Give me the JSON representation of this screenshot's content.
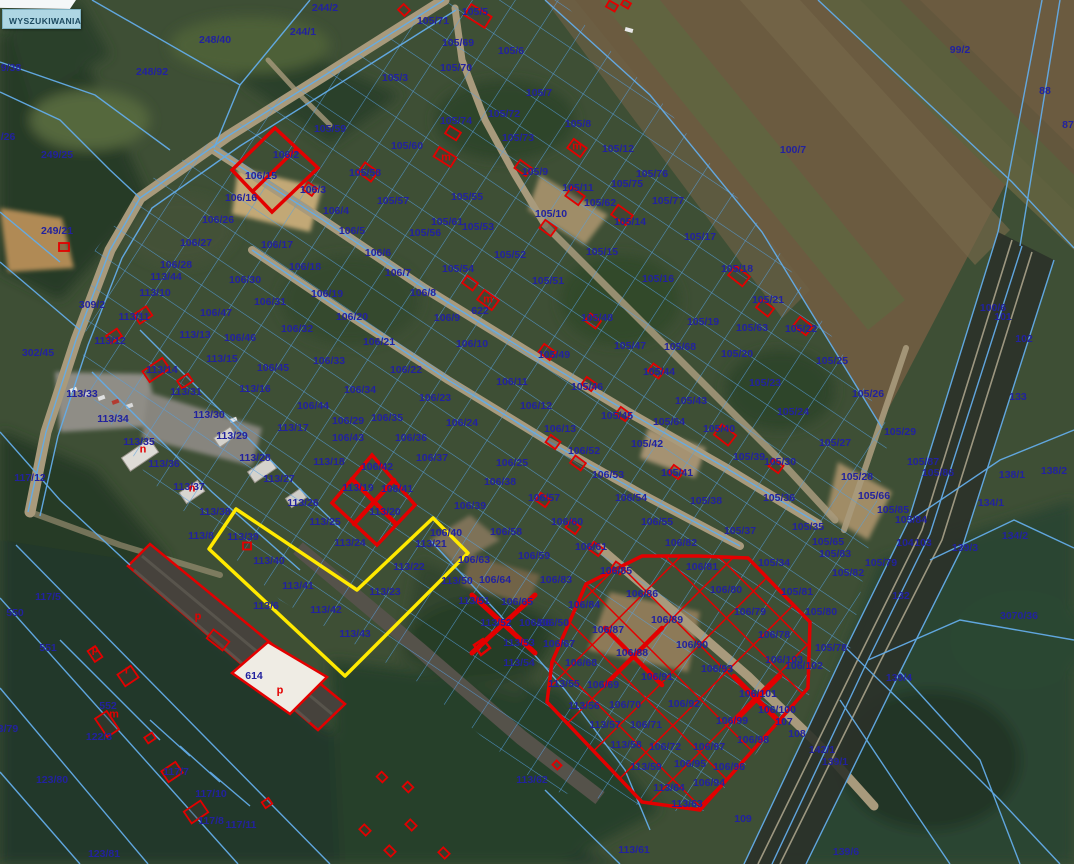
{
  "ui": {
    "search_button": "WYSZUKIWANIA"
  },
  "map": {
    "colors": {
      "parcel_line": "#57a0e0",
      "parcel_label": "#22229e",
      "building_outline": "#e30000",
      "selection_outline": "#ffe900",
      "highlight_grid": "#e30000",
      "field": "#6b5b40",
      "forest": "#273b28",
      "road": "#a89a7c"
    },
    "parcel_labels": [
      [
        "9/38",
        11,
        68
      ],
      [
        "248/92",
        152,
        72
      ],
      [
        "248/40",
        215,
        40
      ],
      [
        "244/2",
        325,
        8
      ],
      [
        "244/1",
        303,
        32
      ],
      [
        "/26",
        8,
        137
      ],
      [
        "249/25",
        57,
        155
      ],
      [
        "249/21",
        57,
        231
      ],
      [
        "309/2",
        92,
        305
      ],
      [
        "302/45",
        38,
        353
      ],
      [
        "105/71",
        433,
        21
      ],
      [
        "105/5",
        475,
        12
      ],
      [
        "105/69",
        458,
        43
      ],
      [
        "105/6",
        511,
        51
      ],
      [
        "105/70",
        456,
        68
      ],
      [
        "105/3",
        395,
        78
      ],
      [
        "105/7",
        539,
        93
      ],
      [
        "105/59",
        330,
        129
      ],
      [
        "105/74",
        456,
        121
      ],
      [
        "105/72",
        504,
        114
      ],
      [
        "105/73",
        518,
        138
      ],
      [
        "105/60",
        407,
        146
      ],
      [
        "105/8",
        578,
        124
      ],
      [
        "105/12",
        618,
        149
      ],
      [
        "99/2",
        960,
        50
      ],
      [
        "88",
        1045,
        91
      ],
      [
        "87",
        1068,
        125
      ],
      [
        "100/7",
        793,
        150
      ],
      [
        "106/2",
        286,
        155
      ],
      [
        "106/15",
        261,
        176
      ],
      [
        "106/16",
        241,
        198
      ],
      [
        "106/26",
        218,
        220
      ],
      [
        "106/27",
        196,
        243
      ],
      [
        "106/28",
        176,
        265
      ],
      [
        "113/44",
        166,
        277
      ],
      [
        "106/3",
        313,
        190
      ],
      [
        "106/4",
        336,
        211
      ],
      [
        "106/5",
        352,
        231
      ],
      [
        "106/6",
        378,
        253
      ],
      [
        "106/7",
        398,
        273
      ],
      [
        "106/8",
        423,
        293
      ],
      [
        "106/9",
        447,
        318
      ],
      [
        "106/10",
        472,
        344
      ],
      [
        "106/11",
        512,
        382
      ],
      [
        "106/12",
        536,
        406
      ],
      [
        "106/13",
        560,
        429
      ],
      [
        "105/58",
        365,
        173
      ],
      [
        "105/57",
        393,
        201
      ],
      [
        "105/56",
        425,
        233
      ],
      [
        "105/61",
        447,
        222
      ],
      [
        "105/55",
        467,
        197
      ],
      [
        "105/53",
        478,
        227
      ],
      [
        "105/9",
        535,
        172
      ],
      [
        "105/11",
        578,
        188
      ],
      [
        "105/10",
        551,
        214
      ],
      [
        "105/62",
        600,
        203
      ],
      [
        "105/75",
        627,
        184
      ],
      [
        "105/76",
        652,
        174
      ],
      [
        "105/77",
        668,
        201
      ],
      [
        "105/14",
        630,
        222
      ],
      [
        "105/15",
        602,
        252
      ],
      [
        "105/52",
        510,
        255
      ],
      [
        "105/51",
        548,
        281
      ],
      [
        "105/16",
        658,
        279
      ],
      [
        "105/17",
        700,
        237
      ],
      [
        "105/18",
        737,
        269
      ],
      [
        "105/54",
        458,
        269
      ],
      [
        "622",
        480,
        311
      ],
      [
        "105/48",
        597,
        318
      ],
      [
        "105/19",
        703,
        322
      ],
      [
        "105/21",
        768,
        300
      ],
      [
        "105/63",
        752,
        328
      ],
      [
        "105/22",
        801,
        329
      ],
      [
        "105/20",
        737,
        354
      ],
      [
        "105/23",
        765,
        383
      ],
      [
        "105/25",
        832,
        361
      ],
      [
        "105/26",
        868,
        394
      ],
      [
        "105/24",
        793,
        412
      ],
      [
        "105/40",
        719,
        429
      ],
      [
        "105/39",
        749,
        457
      ],
      [
        "105/27",
        835,
        443
      ],
      [
        "105/29",
        900,
        432
      ],
      [
        "105/87",
        923,
        462
      ],
      [
        "105/86",
        938,
        473
      ],
      [
        "100/6",
        993,
        308
      ],
      [
        "101",
        1003,
        317
      ],
      [
        "102",
        1024,
        339
      ],
      [
        "133",
        1018,
        397
      ],
      [
        "105/28",
        857,
        477
      ],
      [
        "105/66",
        874,
        496
      ],
      [
        "138/1",
        1012,
        475
      ],
      [
        "138/2",
        1054,
        471
      ],
      [
        "134/1",
        991,
        503
      ],
      [
        "134/2",
        1015,
        536
      ],
      [
        "105/85",
        893,
        510
      ],
      [
        "105/84",
        911,
        520
      ],
      [
        "105/35",
        808,
        527
      ],
      [
        "105/65",
        828,
        542
      ],
      [
        "104",
        905,
        543
      ],
      [
        "103",
        923,
        543
      ],
      [
        "139/3",
        965,
        548
      ],
      [
        "105/83",
        835,
        554
      ],
      [
        "105/79",
        881,
        563
      ],
      [
        "105/82",
        848,
        573
      ],
      [
        "132",
        901,
        596
      ],
      [
        "3070/36",
        1019,
        616
      ],
      [
        "139/4",
        899,
        678
      ],
      [
        "105/80",
        821,
        612
      ],
      [
        "105/78",
        831,
        648
      ],
      [
        "105/81",
        797,
        592
      ],
      [
        "105/34",
        774,
        563
      ],
      [
        "106/17",
        277,
        245
      ],
      [
        "106/18",
        305,
        267
      ],
      [
        "106/19",
        327,
        294
      ],
      [
        "106/20",
        352,
        317
      ],
      [
        "106/21",
        379,
        342
      ],
      [
        "106/22",
        406,
        370
      ],
      [
        "106/23",
        435,
        398
      ],
      [
        "106/24",
        462,
        423
      ],
      [
        "106/30",
        245,
        280
      ],
      [
        "106/31",
        270,
        302
      ],
      [
        "106/32",
        297,
        329
      ],
      [
        "106/33",
        329,
        361
      ],
      [
        "106/34",
        360,
        390
      ],
      [
        "106/44",
        313,
        406
      ],
      [
        "106/29",
        348,
        421
      ],
      [
        "106/43",
        348,
        438
      ],
      [
        "106/45",
        273,
        368
      ],
      [
        "106/46",
        240,
        338
      ],
      [
        "106/47",
        216,
        313
      ],
      [
        "113/10",
        155,
        293
      ],
      [
        "113/11",
        134,
        317
      ],
      [
        "113/12",
        110,
        341
      ],
      [
        "113/13",
        195,
        335
      ],
      [
        "113/15",
        222,
        359
      ],
      [
        "113/16",
        255,
        389
      ],
      [
        "113/14",
        162,
        370
      ],
      [
        "113/31",
        186,
        392
      ],
      [
        "113/30",
        209,
        415
      ],
      [
        "113/29",
        232,
        436
      ],
      [
        "113/28",
        255,
        458
      ],
      [
        "113/27",
        279,
        479
      ],
      [
        "113/26",
        303,
        503
      ],
      [
        "113/25",
        325,
        522
      ],
      [
        "113/24",
        350,
        543
      ],
      [
        "113/17",
        293,
        428
      ],
      [
        "113/18",
        329,
        462
      ],
      [
        "106/42",
        377,
        467
      ],
      [
        "113/19",
        358,
        488
      ],
      [
        "106/41",
        397,
        489
      ],
      [
        "113/20",
        385,
        512
      ],
      [
        "106/35",
        387,
        418
      ],
      [
        "106/36",
        411,
        438
      ],
      [
        "106/37",
        432,
        458
      ],
      [
        "105/49",
        554,
        355
      ],
      [
        "105/46",
        587,
        387
      ],
      [
        "105/45",
        617,
        416
      ],
      [
        "105/47",
        630,
        346
      ],
      [
        "105/44",
        659,
        372
      ],
      [
        "105/68",
        680,
        347
      ],
      [
        "105/43",
        691,
        401
      ],
      [
        "105/64",
        669,
        422
      ],
      [
        "105/42",
        647,
        444
      ],
      [
        "105/41",
        677,
        473
      ],
      [
        "105/30",
        780,
        462
      ],
      [
        "105/36",
        779,
        498
      ],
      [
        "105/37",
        740,
        531
      ],
      [
        "105/38",
        706,
        501
      ],
      [
        "106/25",
        512,
        463
      ],
      [
        "106/38",
        500,
        482
      ],
      [
        "106/39",
        470,
        506
      ],
      [
        "106/58",
        506,
        532
      ],
      [
        "106/59",
        534,
        556
      ],
      [
        "106/57",
        544,
        498
      ],
      [
        "106/60",
        567,
        522
      ],
      [
        "106/61",
        591,
        547
      ],
      [
        "106/52",
        584,
        451
      ],
      [
        "106/53",
        608,
        475
      ],
      [
        "106/54",
        631,
        498
      ],
      [
        "106/55",
        657,
        522
      ],
      [
        "106/82",
        681,
        543
      ],
      [
        "106/83",
        556,
        580
      ],
      [
        "106/64",
        495,
        580
      ],
      [
        "106/65",
        517,
        602
      ],
      [
        "113/51",
        474,
        601
      ],
      [
        "113/52",
        496,
        623
      ],
      [
        "106/66",
        535,
        623
      ],
      [
        "106/50",
        553,
        623
      ],
      [
        "113/53",
        519,
        643
      ],
      [
        "106/67",
        559,
        644
      ],
      [
        "113/54",
        519,
        663
      ],
      [
        "106/63",
        474,
        560
      ],
      [
        "106/40",
        446,
        533
      ],
      [
        "113/50",
        457,
        581
      ],
      [
        "117/12",
        30,
        478
      ],
      [
        "113/33",
        82,
        394
      ],
      [
        "113/34",
        113,
        419
      ],
      [
        "113/35",
        139,
        442
      ],
      [
        "113/36",
        164,
        464
      ],
      [
        "113/37",
        189,
        487
      ],
      [
        "113/38",
        215,
        512
      ],
      [
        "113/8",
        201,
        536
      ],
      [
        "113/6",
        266,
        606
      ],
      [
        "113/39",
        243,
        537
      ],
      [
        "113/40",
        269,
        561
      ],
      [
        "113/41",
        298,
        586
      ],
      [
        "113/42",
        326,
        610
      ],
      [
        "113/43",
        355,
        634
      ],
      [
        "113/21",
        431,
        544
      ],
      [
        "113/22",
        409,
        567
      ],
      [
        "113/23",
        385,
        592
      ],
      [
        "117/5",
        48,
        597
      ],
      [
        "550",
        15,
        613
      ],
      [
        "551",
        48,
        648
      ],
      [
        "552",
        108,
        706
      ],
      [
        "122/3",
        99,
        737
      ],
      [
        "3/79",
        8,
        729
      ],
      [
        "123/80",
        52,
        780
      ],
      [
        "123/81",
        104,
        854
      ],
      [
        "117/7",
        176,
        772
      ],
      [
        "117/10",
        211,
        794
      ],
      [
        "117/8",
        211,
        821
      ],
      [
        "117/11",
        241,
        825
      ],
      [
        "614",
        254,
        676
      ],
      [
        "106/85",
        616,
        571
      ],
      [
        "106/81",
        702,
        567
      ],
      [
        "106/86",
        642,
        594
      ],
      [
        "106/80",
        726,
        590
      ],
      [
        "106/79",
        750,
        612
      ],
      [
        "106/84",
        584,
        605
      ],
      [
        "106/89",
        667,
        620
      ],
      [
        "106/87",
        608,
        630
      ],
      [
        "106/78",
        774,
        635
      ],
      [
        "106/90",
        692,
        645
      ],
      [
        "106/88",
        632,
        653
      ],
      [
        "106/103",
        784,
        660
      ],
      [
        "106/102",
        804,
        666
      ],
      [
        "106/68",
        581,
        663
      ],
      [
        "106/93",
        717,
        669
      ],
      [
        "106/69",
        603,
        685
      ],
      [
        "113/55",
        564,
        684
      ],
      [
        "106/91",
        657,
        677
      ],
      [
        "113/56",
        584,
        706
      ],
      [
        "106/70",
        625,
        705
      ],
      [
        "106/92",
        684,
        704
      ],
      [
        "106/101",
        758,
        694
      ],
      [
        "106/100",
        777,
        710
      ],
      [
        "113/57",
        605,
        725
      ],
      [
        "106/71",
        646,
        725
      ],
      [
        "106/99",
        732,
        721
      ],
      [
        "107",
        784,
        722
      ],
      [
        "108",
        797,
        734
      ],
      [
        "106/98",
        753,
        740
      ],
      [
        "113/58",
        626,
        745
      ],
      [
        "106/72",
        665,
        747
      ],
      [
        "106/97",
        709,
        747
      ],
      [
        "113/59",
        646,
        767
      ],
      [
        "106/95",
        690,
        764
      ],
      [
        "106/96",
        729,
        767
      ],
      [
        "113/64",
        669,
        788
      ],
      [
        "106/94",
        709,
        783
      ],
      [
        "113/63",
        687,
        804
      ],
      [
        "109",
        743,
        819
      ],
      [
        "113/61",
        634,
        850
      ],
      [
        "142/1",
        822,
        750
      ],
      [
        "139/1",
        835,
        762
      ],
      [
        "139/6",
        846,
        852
      ],
      [
        "113/62",
        532,
        780
      ]
    ],
    "building_letters": [
      [
        "m",
        577,
        147
      ],
      [
        "m",
        446,
        158
      ],
      [
        "m",
        488,
        300
      ],
      [
        "n",
        143,
        450
      ],
      [
        "n",
        192,
        489
      ],
      [
        "p",
        198,
        617
      ],
      [
        "p",
        95,
        650
      ],
      [
        "m",
        114,
        715
      ],
      [
        "r",
        127,
        671
      ],
      [
        "p",
        280,
        691
      ]
    ]
  }
}
